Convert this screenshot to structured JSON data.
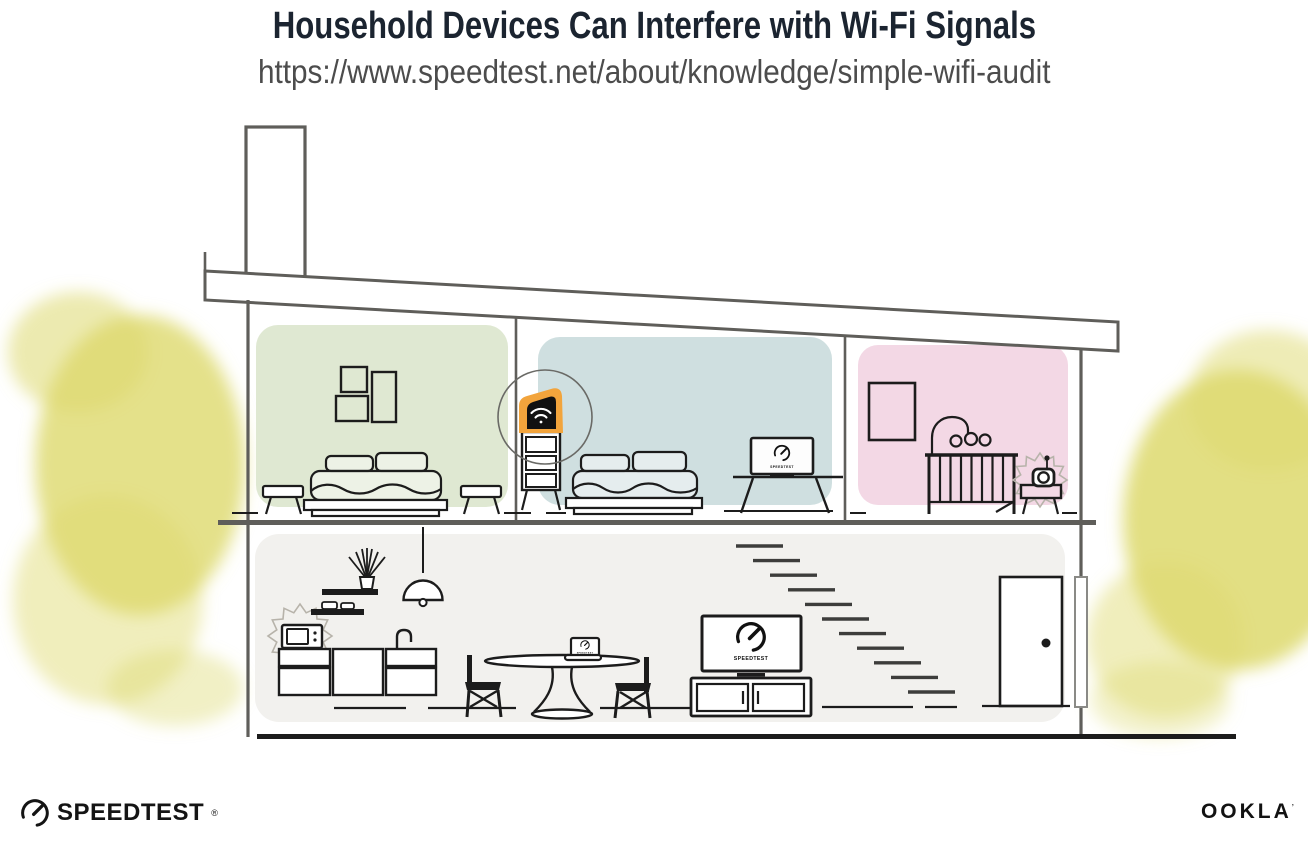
{
  "header": {
    "title": "Household Devices Can Interfere with Wi-Fi Signals",
    "url": "https://www.speedtest.net/about/knowledge/simple-wifi-audit"
  },
  "screens": {
    "bedroom_tv_label": "SPEEDTEST",
    "living_tv_label": "SPEEDTEST",
    "laptop_label": "SPEEDTEST"
  },
  "footer": {
    "speedtest": "SPEEDTEST",
    "speedtest_reg": "®",
    "ookla": "OOKLA",
    "ookla_mark": "ʼ"
  },
  "colors": {
    "room-green": "#dfe8d2",
    "room-blue": "#cfdfe0",
    "room-pink": "#f3d8e5",
    "floor-gray": "#f2f1ee",
    "accent-orange": "#f2a43c",
    "structure-gray": "#5f5e5a",
    "ink": "#1c1c1c",
    "tree-yellow": "#ddd96d",
    "title-navy": "#1b2430",
    "url-gray": "#4c4c4c",
    "burst-gray": "#b7b3aa"
  }
}
